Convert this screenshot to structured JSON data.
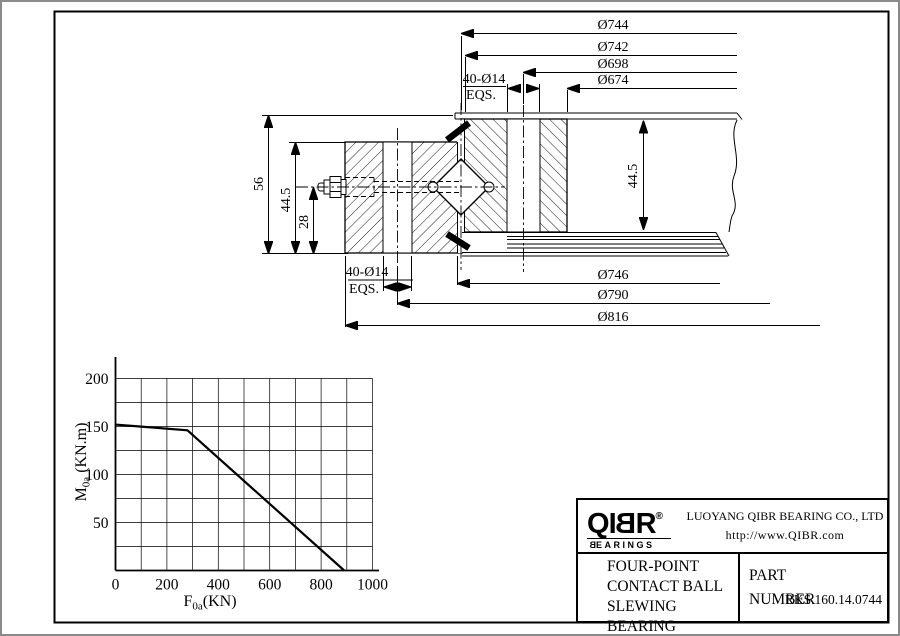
{
  "drawing": {
    "dims_top": [
      "Ø744",
      "Ø742",
      "Ø698",
      "Ø674"
    ],
    "dims_bottom": [
      "Ø746",
      "Ø790",
      "Ø816"
    ],
    "bolt_spec": {
      "spec": "40-Ø14",
      "note": "EQS."
    },
    "heights": {
      "left_total": "56",
      "left_ring": "44.5",
      "left_nipple": "28",
      "right_ring": "44.5"
    }
  },
  "chart_data": {
    "type": "line",
    "title": "",
    "xlabel": "F0a (KN)",
    "ylabel": "M0a (KN.m)",
    "xlabel_parts": {
      "base": "F",
      "sub": "0a",
      "rest": "(KN)"
    },
    "ylabel_parts": {
      "base": "M",
      "sub": "0a",
      "rest": " (KN.m)"
    },
    "xlim": [
      0,
      1000
    ],
    "ylim": [
      0,
      200
    ],
    "x_grid_step": 100,
    "y_grid_step": 25,
    "x_tick_labels": [
      0,
      200,
      400,
      600,
      800,
      1000
    ],
    "y_tick_labels": [
      50,
      100,
      150,
      200
    ],
    "grid": true,
    "legend_position": "none",
    "series": [
      {
        "name": "static-load-limit-curve",
        "points": [
          [
            0,
            152
          ],
          [
            280,
            146
          ],
          [
            890,
            0
          ]
        ]
      }
    ]
  },
  "title_block": {
    "brand": {
      "name": "QIBR",
      "word_letters": [
        "Q",
        "I",
        "B",
        "R"
      ],
      "reg": "®",
      "sub_first": "B",
      "sub_rest": "EARINGS"
    },
    "company": "LUOYANG QIBR BEARING CO., LTD",
    "website": "http://www.QIBR.com",
    "product_lines": [
      "FOUR-POINT",
      "CONTACT BALL",
      "SLEWING BEARING"
    ],
    "part_label_line1": "PART",
    "part_label_line2": "NUMBER",
    "part_number": "RKS.160.14.0744"
  }
}
